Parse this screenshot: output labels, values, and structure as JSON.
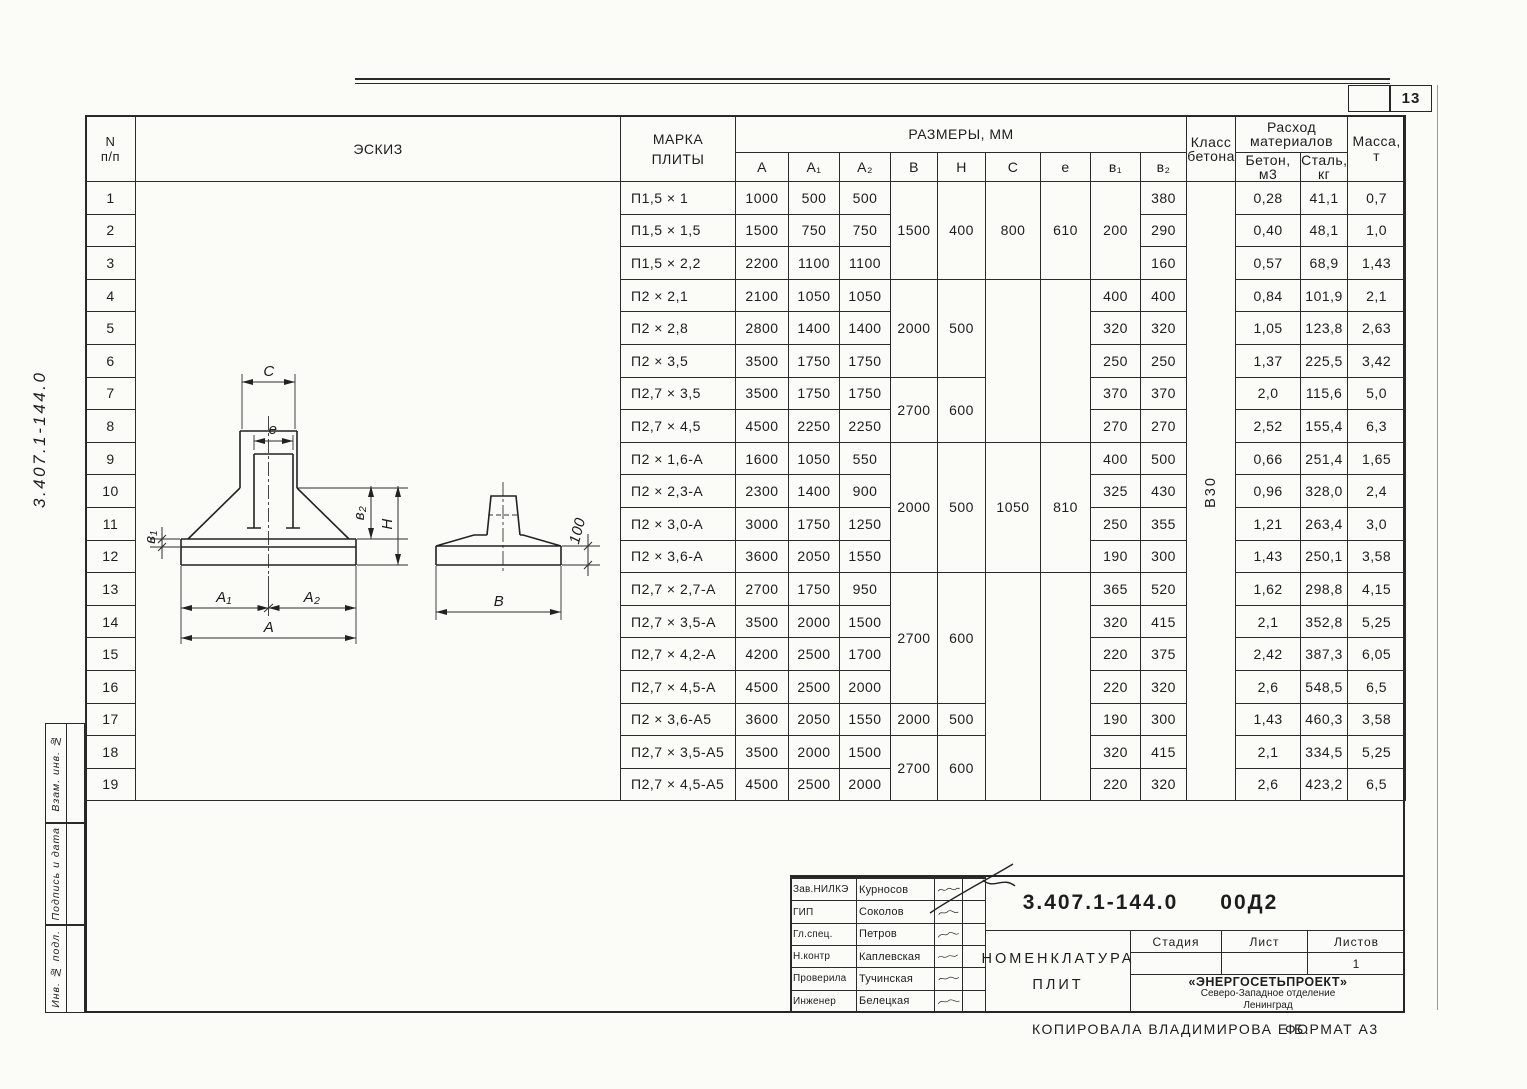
{
  "page": {
    "sheet_number": "13",
    "copy_note": "КОПИРОВАЛА  ВЛАДИМИРОВА Е.Б.",
    "format_note": "ФОРМАТ А3",
    "margin_doc_number": "3.407.1-144.0",
    "margin_labels": {
      "vzam": "Взам. инв. №",
      "podpis": "Подпись и дата",
      "inv": "Инв. № подл."
    }
  },
  "table": {
    "header": {
      "num": "N",
      "num_sub": "п/п",
      "sketch": "ЭСКИЗ",
      "mark_line1": "МАРКА",
      "mark_line2": "ПЛИТЫ",
      "dims": "РАЗМЕРЫ, ММ",
      "col_a": "A",
      "col_a1": "A₁",
      "col_a2": "A₂",
      "col_b": "B",
      "col_h": "H",
      "col_c": "C",
      "col_e": "e",
      "col_b1": "в₁",
      "col_b2": "в₂",
      "concrete_class": "Класс бетона",
      "materials": "Расход материалов",
      "concrete": "Бетон, м3",
      "steel": "Сталь, кг",
      "mass": "Масса, т"
    },
    "concrete_class_value": "В30",
    "groups": {
      "bh": [
        {
          "b": "1500",
          "h": "400"
        },
        {
          "b": "2000",
          "h": "500"
        },
        {
          "b": "2700",
          "h": "600"
        },
        {
          "b": "2000",
          "h": "500"
        },
        {
          "b": "2700",
          "h": "600"
        },
        {
          "b": "2000",
          "h": "500"
        },
        {
          "b": "2700",
          "h": "600"
        }
      ],
      "ce": [
        {
          "c": "800",
          "e": "610"
        },
        {
          "c": "1050",
          "e": "810"
        }
      ],
      "b1_rows_1_3": "200"
    },
    "rows": [
      {
        "n": "1",
        "mark": "П1,5 × 1",
        "a": "1000",
        "a1": "500",
        "a2": "500",
        "b2": "380",
        "concrete": "0,28",
        "steel": "41,1",
        "mass": "0,7"
      },
      {
        "n": "2",
        "mark": "П1,5 × 1,5",
        "a": "1500",
        "a1": "750",
        "a2": "750",
        "b2": "290",
        "concrete": "0,40",
        "steel": "48,1",
        "mass": "1,0"
      },
      {
        "n": "3",
        "mark": "П1,5 × 2,2",
        "a": "2200",
        "a1": "1100",
        "a2": "1100",
        "b2": "160",
        "concrete": "0,57",
        "steel": "68,9",
        "mass": "1,43"
      },
      {
        "n": "4",
        "mark": "П2 × 2,1",
        "a": "2100",
        "a1": "1050",
        "a2": "1050",
        "b1": "400",
        "b2": "400",
        "concrete": "0,84",
        "steel": "101,9",
        "mass": "2,1"
      },
      {
        "n": "5",
        "mark": "П2 × 2,8",
        "a": "2800",
        "a1": "1400",
        "a2": "1400",
        "b1": "320",
        "b2": "320",
        "concrete": "1,05",
        "steel": "123,8",
        "mass": "2,63"
      },
      {
        "n": "6",
        "mark": "П2 × 3,5",
        "a": "3500",
        "a1": "1750",
        "a2": "1750",
        "b1": "250",
        "b2": "250",
        "concrete": "1,37",
        "steel": "225,5",
        "mass": "3,42"
      },
      {
        "n": "7",
        "mark": "П2,7 × 3,5",
        "a": "3500",
        "a1": "1750",
        "a2": "1750",
        "b1": "370",
        "b2": "370",
        "concrete": "2,0",
        "steel": "115,6",
        "mass": "5,0"
      },
      {
        "n": "8",
        "mark": "П2,7 × 4,5",
        "a": "4500",
        "a1": "2250",
        "a2": "2250",
        "b1": "270",
        "b2": "270",
        "concrete": "2,52",
        "steel": "155,4",
        "mass": "6,3"
      },
      {
        "n": "9",
        "mark": "П2 × 1,6-А",
        "a": "1600",
        "a1": "1050",
        "a2": "550",
        "b1": "400",
        "b2": "500",
        "concrete": "0,66",
        "steel": "251,4",
        "mass": "1,65"
      },
      {
        "n": "10",
        "mark": "П2 × 2,3-А",
        "a": "2300",
        "a1": "1400",
        "a2": "900",
        "b1": "325",
        "b2": "430",
        "concrete": "0,96",
        "steel": "328,0",
        "mass": "2,4"
      },
      {
        "n": "11",
        "mark": "П2 × 3,0-А",
        "a": "3000",
        "a1": "1750",
        "a2": "1250",
        "b1": "250",
        "b2": "355",
        "concrete": "1,21",
        "steel": "263,4",
        "mass": "3,0"
      },
      {
        "n": "12",
        "mark": "П2 × 3,6-А",
        "a": "3600",
        "a1": "2050",
        "a2": "1550",
        "b1": "190",
        "b2": "300",
        "concrete": "1,43",
        "steel": "250,1",
        "mass": "3,58"
      },
      {
        "n": "13",
        "mark": "П2,7 × 2,7-А",
        "a": "2700",
        "a1": "1750",
        "a2": "950",
        "b1": "365",
        "b2": "520",
        "concrete": "1,62",
        "steel": "298,8",
        "mass": "4,15"
      },
      {
        "n": "14",
        "mark": "П2,7 × 3,5-А",
        "a": "3500",
        "a1": "2000",
        "a2": "1500",
        "b1": "320",
        "b2": "415",
        "concrete": "2,1",
        "steel": "352,8",
        "mass": "5,25"
      },
      {
        "n": "15",
        "mark": "П2,7 × 4,2-А",
        "a": "4200",
        "a1": "2500",
        "a2": "1700",
        "b1": "220",
        "b2": "375",
        "concrete": "2,42",
        "steel": "387,3",
        "mass": "6,05"
      },
      {
        "n": "16",
        "mark": "П2,7 × 4,5-А",
        "a": "4500",
        "a1": "2500",
        "a2": "2000",
        "b1": "220",
        "b2": "320",
        "concrete": "2,6",
        "steel": "548,5",
        "mass": "6,5"
      },
      {
        "n": "17",
        "mark": "П2 × 3,6-А5",
        "a": "3600",
        "a1": "2050",
        "a2": "1550",
        "b": "2000",
        "h": "500",
        "b1": "190",
        "b2": "300",
        "concrete": "1,43",
        "steel": "460,3",
        "mass": "3,58"
      },
      {
        "n": "18",
        "mark": "П2,7 × 3,5-А5",
        "a": "3500",
        "a1": "2000",
        "a2": "1500",
        "b1": "320",
        "b2": "415",
        "concrete": "2,1",
        "steel": "334,5",
        "mass": "5,25"
      },
      {
        "n": "19",
        "mark": "П2,7 × 4,5-А5",
        "a": "4500",
        "a1": "2500",
        "a2": "2000",
        "b1": "220",
        "b2": "320",
        "concrete": "2,6",
        "steel": "423,2",
        "mass": "6,5"
      }
    ]
  },
  "sketch": {
    "dim_c": "C",
    "dim_e": "e",
    "dim_b1": "в₁",
    "dim_b2": "в₂",
    "dim_h": "H",
    "dim_a1": "A₁",
    "dim_a2": "A₂",
    "dim_a": "A",
    "dim_b": "B",
    "dim_lip": "100"
  },
  "title_block": {
    "doc_number": "3.407.1-144.0",
    "doc_suffix": "00Д2",
    "title_line1": "НОМЕНКЛАТУРА",
    "title_line2": "ПЛИТ",
    "stage_label": "Стадия",
    "sheet_label": "Лист",
    "sheets_label": "Листов",
    "stage_value": "",
    "sheet_value": "",
    "sheets_value": "1",
    "org_line1": "«ЭНЕРГОСЕТЬПРОЕКТ»",
    "org_line2": "Северо-Западное отделение",
    "org_line3": "Ленинград",
    "signers": [
      {
        "role": "Зав.НИЛКЭ",
        "name": "Курносов"
      },
      {
        "role": "ГИП",
        "name": "Соколов"
      },
      {
        "role": "Гл.спец.",
        "name": "Петров"
      },
      {
        "role": "Н.контр",
        "name": "Каплевская"
      },
      {
        "role": "Проверила",
        "name": "Тучинская"
      },
      {
        "role": "Инженер",
        "name": "Белецкая"
      }
    ]
  }
}
